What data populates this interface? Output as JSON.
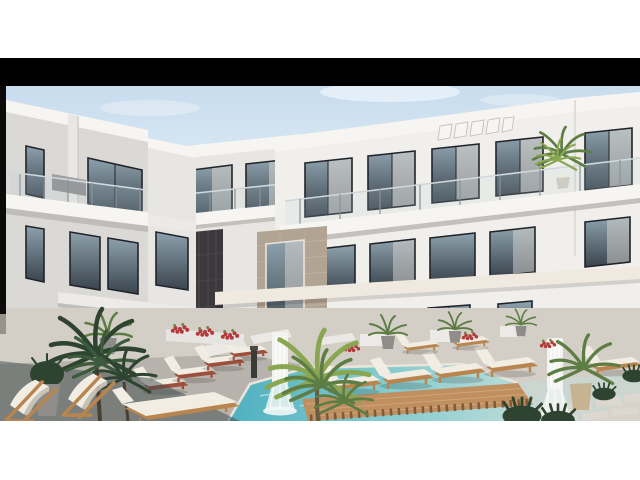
{
  "meta": {
    "type": "architectural-rendering-photo",
    "description": "3D rendering of a modern white three-storey resort apartment complex with glass-railed balconies, dark-framed windows, stone-clad accents, a turquoise courtyard swimming pool with a wooden sun deck, rows of white sun loungers, cascading white fountains, palm trees and potted plants"
  },
  "frame": {
    "matte_color": "#ffffff",
    "letterbox_color": "#000000"
  },
  "palette": {
    "matte": "#ffffff",
    "letterbox": "#000000",
    "sky_top": "#c7dcee",
    "sky_bottom": "#ecf4f9",
    "wall_left": "#dbd9d6",
    "wall_mid": "#e8e6e2",
    "wall_right": "#f1efeb",
    "fascia_white": "#f7f5f2",
    "slab_shadow": "#b3b0ad",
    "window_glass_dark": "#39444e",
    "window_glass_light": "#8ea1ac",
    "window_frame": "#20242a",
    "curtain": "#d9d5d0",
    "stone_dark": "#3b393c",
    "stone_dark_hi": "#555256",
    "stone_beige": "#b2a493",
    "stone_beige_hi": "#c4b8a7",
    "canopy": "#efe9e0",
    "railing_glass": "#bcd3da",
    "railing_post": "#8a9298",
    "pool_deep": "#4fb0c0",
    "pool_mid": "#7fc9cd",
    "pool_pale": "#c3ded8",
    "deck_wood": "#c08f60",
    "deck_wood_dark": "#7c5a3a",
    "deck_wood_light": "#d8b285",
    "deck_stone": "#b7b2ab",
    "back_deck": "#d3cec6",
    "ground_right": "#d8d3ca",
    "wet_stone": "#cbd6d0",
    "paver": "#dcd8d0",
    "cushion": "#f1ede3",
    "lounger_wood": "#b9854f",
    "lounger_red": "#9c4f3a",
    "plant_dark": "#2e4430",
    "plant_mid": "#5d7d45",
    "plant_light": "#8aa651",
    "flower_red": "#b4393b",
    "fountain_white": "#f3f4f1",
    "shadow_dark": "#3e4c4d"
  },
  "scene": {
    "elements": [
      "left apartment wing with two balcony levels",
      "rear center wing",
      "right apartment wing with curtained windows and glass balustrade",
      "dark stone clad column",
      "beige stone accent wall",
      "long white canopy slab",
      "pergola slats detail",
      "balcony palm plant",
      "courtyard swimming pool",
      "wooden slatted pool deck",
      "white cascading fountain left",
      "white cascading fountain right",
      "row of sun loungers on wooden deck",
      "row of sun loungers with red bases",
      "foreground sling chairs",
      "foreground flat lounger",
      "dark foreground palm tree",
      "yellow-green center palm",
      "potted plants along facade",
      "red flower planters",
      "stepping stone pavers",
      "dark green bushes",
      "gray planter pot"
    ]
  }
}
